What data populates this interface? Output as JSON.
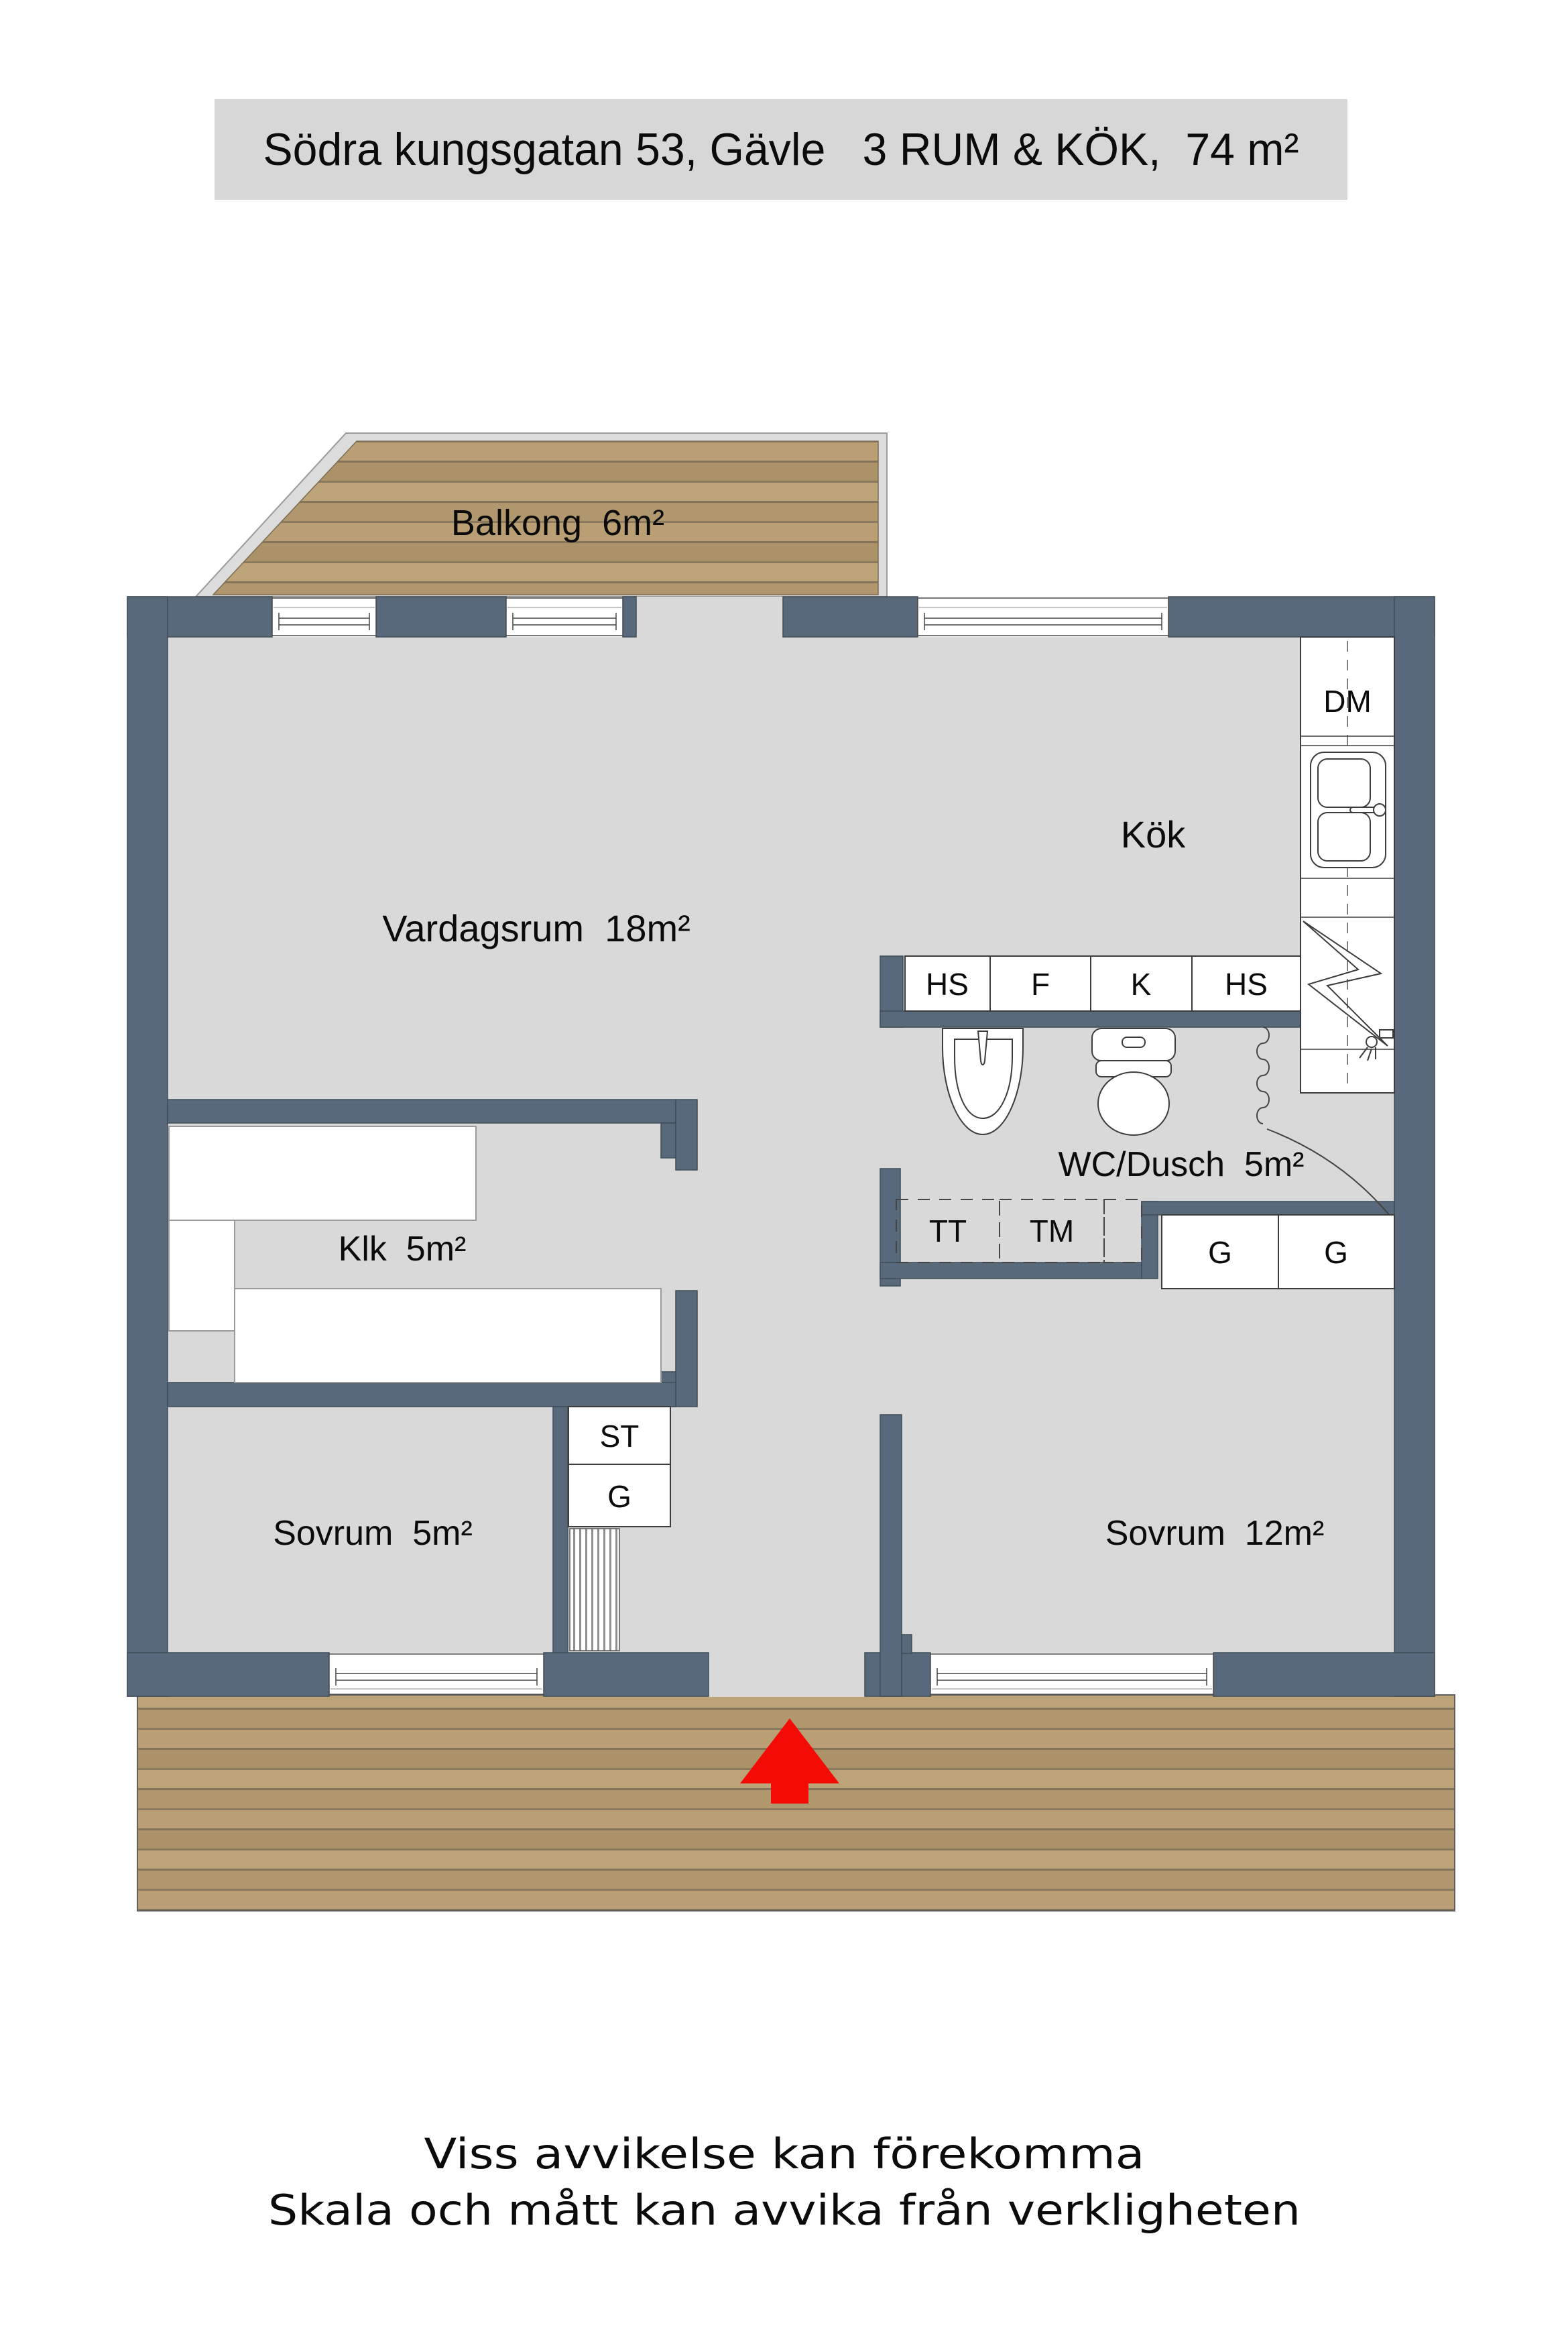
{
  "title": {
    "text": "Södra kungsgatan 53, Gävle   3 RUM & KÖK,  74 m²"
  },
  "rooms": {
    "balcony": {
      "label": "Balkong  6m²"
    },
    "living": {
      "label": "Vardagsrum  18m²"
    },
    "kitchen": {
      "label": "Kök"
    },
    "closet": {
      "label": "Klk  5m²"
    },
    "bath": {
      "label": "WC/Dusch  5m²"
    },
    "bedroom_small": {
      "label": "Sovrum  5m²"
    },
    "bedroom_large": {
      "label": "Sovrum  12m²"
    }
  },
  "fixtures": {
    "dishwasher": "DM",
    "cabinet_hs_left": "HS",
    "freezer_f": "F",
    "fridge_k": "K",
    "cabinet_hs_right": "HS",
    "dryer_tt": "TT",
    "washer_tm": "TM",
    "wardrobe_g1": "G",
    "wardrobe_g2": "G",
    "cleaning_st": "ST",
    "wardrobe_g3": "G"
  },
  "footer": {
    "line1": "Viss avvikelse kan förekomma",
    "line2": "Skala och mått kan avvika från verkligheten"
  },
  "colors": {
    "wall": "#57697a",
    "wall_outline": "#3e4d59",
    "floor": "#d9d9d9",
    "title_bg": "#d7d7d7",
    "wood_plank": "#b69d74",
    "wood_seam": "#84755a",
    "arrow_red": "#f40b06"
  }
}
